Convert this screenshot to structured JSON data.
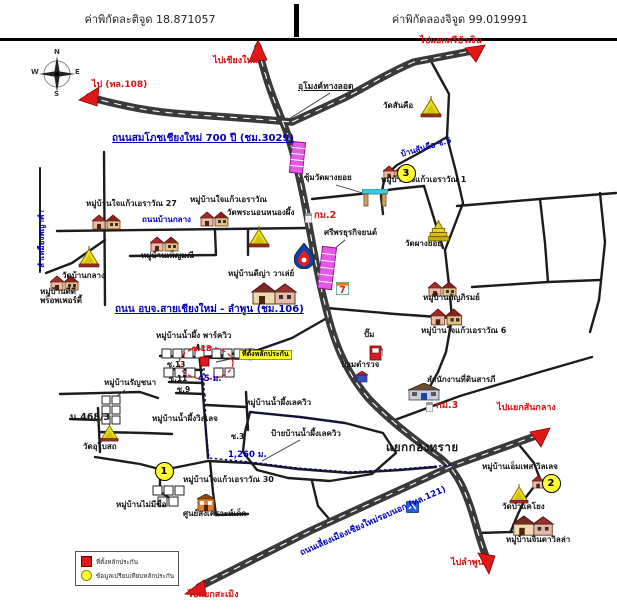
{
  "header": {
    "latitude": "ค่าพิกัดละติจูด 18.871057",
    "longitude": "ค่าพิกัดลองจิจูด 99.019991"
  },
  "compass": {
    "north": "N",
    "south": "S",
    "east": "E",
    "west": "W"
  },
  "legend": {
    "items": [
      {
        "symbol": "red-square",
        "label": "ที่ตั้งหลักประกัน"
      },
      {
        "symbol": "yellow-circle",
        "label": "ข้อมูลเปรียบเทียบหลักประกัน"
      }
    ]
  },
  "colors": {
    "road": "#3a3a3a",
    "arrow": "#e01818",
    "road_label": "#0000bb",
    "direction_label": "#d51212",
    "marker_fill": "#ffff33",
    "collateral": "#e01818",
    "highlight_tag": "#ffff30",
    "shophouse": "#e858e8"
  },
  "icons": {
    "temple": "temple-icon",
    "pagoda": "pagoda-icon",
    "village_houses": "village-houses-icon",
    "large_house": "large-house-icon",
    "gate": "temple-gate-icon",
    "ptt_station": "ptt-gas-icon",
    "seven_eleven": "seven-eleven-icon",
    "fuel_pump": "fuel-pump-icon",
    "police_box": "police-box-icon",
    "office_building": "office-building-icon",
    "orange_building": "orange-building-icon",
    "km_post": "km-milestone-icon",
    "highway_shield": "highway-shield-icon",
    "compass_rose": "compass-rose-icon",
    "red_arrow": "direction-arrow-icon"
  },
  "markers": [
    {
      "n": "1",
      "x": 163,
      "y": 470
    },
    {
      "n": "2",
      "x": 550,
      "y": 482
    },
    {
      "n": "3",
      "x": 405,
      "y": 172
    }
  ],
  "labels": [
    {
      "id": "dir-chiangmai",
      "t": "ไปเชียงใหม่",
      "x": 213,
      "y": 57,
      "c": "red",
      "fs": 9
    },
    {
      "id": "dir-sribuangern",
      "t": "ไปแยกศรีบัวเงิน",
      "x": 420,
      "y": 37,
      "c": "red",
      "fs": 9
    },
    {
      "id": "dir-108",
      "t": "ไป (ทล.108)",
      "x": 92,
      "y": 81,
      "c": "red",
      "fs": 9
    },
    {
      "id": "dir-sanklang",
      "t": "ไปแยกสันกลาง",
      "x": 497,
      "y": 404,
      "c": "red",
      "fs": 9
    },
    {
      "id": "dir-lamphun",
      "t": "ไปลำพูน",
      "x": 451,
      "y": 559,
      "c": "red",
      "fs": 9
    },
    {
      "id": "dir-samoeng",
      "t": "ไปแยกสะเมิง",
      "x": 188,
      "y": 591,
      "c": "red",
      "fs": 9
    },
    {
      "id": "road-700pi",
      "t": "ถนนสมโภชเชียงใหม่ 700 ปี (ชม.3029)",
      "x": 112,
      "y": 133,
      "c": "blueu",
      "fs": 10
    },
    {
      "id": "road-106",
      "t": "ถนน อบจ.สายเชียงใหม่ - ลำพูน (ชม.106)",
      "x": 115,
      "y": 304,
      "c": "blueu",
      "fs": 10
    },
    {
      "id": "road-banklang",
      "t": "ถนนบ้านกลาง",
      "x": 142,
      "y": 216,
      "c": "blue"
    },
    {
      "id": "road-sankue-soi5",
      "t": "บ้านสันคือ ซ.5",
      "x": 400,
      "y": 151,
      "c": "blue",
      "rot": -16
    },
    {
      "id": "road-121",
      "t": "ถนนเลี่ยงเมืองเชียงใหม่รอบนอก (ทล.121)",
      "x": 299,
      "y": 550,
      "c": "blue",
      "fs": 8.5,
      "rot": -24
    },
    {
      "id": "road-canal",
      "t": "ลำเหมืองพญาคำ",
      "x": 38,
      "y": 268,
      "c": "blue",
      "rot": -90
    },
    {
      "id": "km2",
      "t": "กม.2",
      "x": 314,
      "y": 211,
      "c": "red",
      "fs": 9.5
    },
    {
      "id": "km3",
      "t": "กม.3",
      "x": 436,
      "y": 401,
      "c": "red",
      "fs": 9.5
    },
    {
      "id": "soi18",
      "t": "ซ.18",
      "x": 192,
      "y": 345,
      "c": "red",
      "fs": 8
    },
    {
      "id": "dist-45m",
      "t": "45 ม.",
      "x": 198,
      "y": 375,
      "c": "blue",
      "fs": 8.5
    },
    {
      "id": "dist-1260m",
      "t": "1,260 ม.",
      "x": 228,
      "y": 451,
      "c": "blue",
      "fs": 8.5
    },
    {
      "id": "tunnel",
      "t": "อุโมงค์ทางลอด",
      "x": 298,
      "y": 83,
      "c": "blku",
      "fs": 8.5
    },
    {
      "id": "wat-sankue",
      "t": "วัดสันคือ",
      "x": 383,
      "y": 102
    },
    {
      "id": "vill-jaikaew1",
      "t": "หมู่บ้านใจแก้วเอราวัณ 1",
      "x": 381,
      "y": 176
    },
    {
      "id": "gate-phangyoi",
      "t": "ซุ้มวัดผางยอย",
      "x": 304,
      "y": 174
    },
    {
      "id": "sriphon-business",
      "t": "ศรีพรธุรกิจยนต์",
      "x": 324,
      "y": 229
    },
    {
      "id": "wat-phangyoi",
      "t": "วัดผางยอย",
      "x": 405,
      "y": 240
    },
    {
      "id": "vill-kanphirom",
      "t": "หมู่บ้านกัญภิรมย์",
      "x": 423,
      "y": 294
    },
    {
      "id": "vill-jaikaew6",
      "t": "หมู่บ้านใจแก้วเอราวัณ 6",
      "x": 421,
      "y": 327
    },
    {
      "id": "vill-jaikaew27",
      "t": "หมู่บ้านใจแก้วเอราวัณ 27",
      "x": 86,
      "y": 200
    },
    {
      "id": "vill-jaikaew",
      "t": "หมู่บ้านใจแก้วเอราวัณ",
      "x": 190,
      "y": 196
    },
    {
      "id": "wat-phranon",
      "t": "วัดพระนอนหนองผึ้ง",
      "x": 227,
      "y": 209
    },
    {
      "id": "wat-banklang",
      "t": "วัดบ้านกลาง",
      "x": 62,
      "y": 272
    },
    {
      "id": "vill-phenmani",
      "t": "หมู่บ้านเพ็ญมณี",
      "x": 141,
      "y": 252
    },
    {
      "id": "vill-dd-property",
      "t": "หมู่บ้านดีดี\nพร็อพเพอร์ตี้",
      "x": 40,
      "y": 288
    },
    {
      "id": "vill-dya-valley",
      "t": "หมู่บ้านดีญ่า วาเล่ย์",
      "x": 228,
      "y": 270
    },
    {
      "id": "gas-pump",
      "t": "ปั๊ม",
      "x": 364,
      "y": 331
    },
    {
      "id": "police-box",
      "t": "ป้อมตำรวจ",
      "x": 341,
      "y": 361
    },
    {
      "id": "land-office",
      "t": "สำนักงานที่ดินสารภี",
      "x": 427,
      "y": 376
    },
    {
      "id": "kongsai-junction",
      "t": "แยกกองทราย",
      "x": 386,
      "y": 441,
      "c": "blk big"
    },
    {
      "id": "vill-empes",
      "t": "หมู่บ้านเอ็มเพส วิลเลจ",
      "x": 482,
      "y": 463
    },
    {
      "id": "wat-pakaeyong",
      "t": "วัดป่าแคโยง",
      "x": 502,
      "y": 503
    },
    {
      "id": "vill-jinda",
      "t": "หมู่บ้านจินดาวิลล่า",
      "x": 506,
      "y": 536
    },
    {
      "id": "vill-parkview",
      "t": "หมู่บ้านน้ำผึ้ง พาร์ควิว",
      "x": 156,
      "y": 332
    },
    {
      "id": "soi13",
      "t": "ซ.13",
      "x": 167,
      "y": 361,
      "fs": 7.5
    },
    {
      "id": "soi11",
      "t": "ซ.11",
      "x": 169,
      "y": 375,
      "fs": 7.5
    },
    {
      "id": "soi9",
      "t": "ซ.9",
      "x": 177,
      "y": 386,
      "fs": 7.5
    },
    {
      "id": "vill-ranchana",
      "t": "หมู่บ้านรัญชนา",
      "x": 104,
      "y": 379
    },
    {
      "id": "no-4683",
      "t": "น.468/3",
      "x": 70,
      "y": 413,
      "fs": 9.5
    },
    {
      "id": "wat-ubosot",
      "t": "วัดอุโบสถ",
      "x": 83,
      "y": 443
    },
    {
      "id": "vill-village",
      "t": "หมู่บ้านน้ำผึ้งวิลเลจ",
      "x": 152,
      "y": 415
    },
    {
      "id": "soi3",
      "t": "ซ.3",
      "x": 231,
      "y": 433,
      "fs": 7.5
    },
    {
      "id": "vill-lakeview",
      "t": "หมู่บ้านน้ำผึ้งเลควิว",
      "x": 245,
      "y": 399
    },
    {
      "id": "sign-lakeview",
      "t": "ป้ายบ้านน้ำผึ้งเลควิว",
      "x": 271,
      "y": 430
    },
    {
      "id": "vill-jaikaew30",
      "t": "หมู่บ้านใจแก้วเอราวัณ 30",
      "x": 183,
      "y": 476
    },
    {
      "id": "vill-noname",
      "t": "หมู่บ้านไม่มีชื่อ",
      "x": 116,
      "y": 501
    },
    {
      "id": "child-center",
      "t": "ศูนย์สงเคราะห์เด็ก",
      "x": 183,
      "y": 510
    },
    {
      "id": "collateral-tag",
      "t": "ที่ตั้งหลักประกัน",
      "x": 239,
      "y": 350,
      "c": "tag"
    }
  ]
}
